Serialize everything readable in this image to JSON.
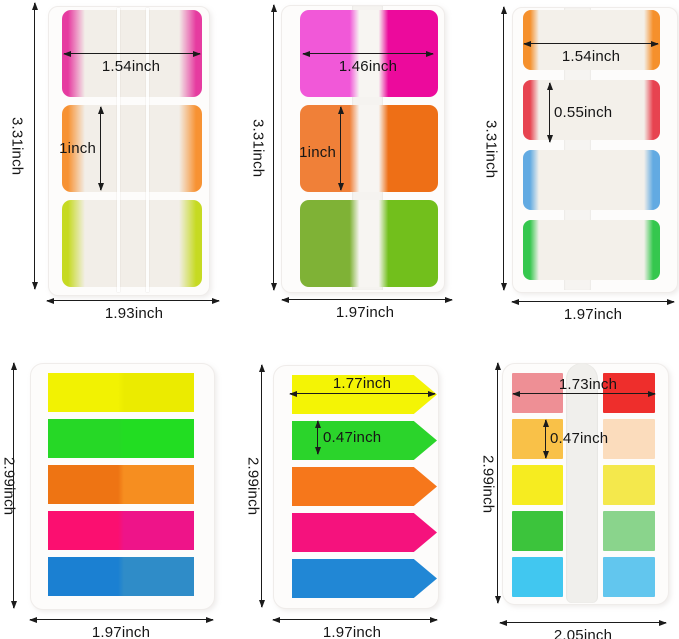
{
  "panels": [
    {
      "tab_style": "edge",
      "labels": {
        "overall_height": "3.31inch",
        "overall_width": "1.93inch",
        "tab_width": "1.54inch",
        "tab_height": "1inch"
      },
      "tab_colors": [
        "#e63ba0",
        "#f79233",
        "#c6da22"
      ]
    },
    {
      "tab_style": "half",
      "labels": {
        "overall_height": "3.31inch",
        "overall_width": "1.97inch",
        "tab_width": "1.46inch",
        "tab_height": "1inch"
      },
      "tab_colors": [
        [
          "#f158d8",
          "#ec0a9c"
        ],
        [
          "#f08038",
          "#ee6f16"
        ],
        [
          "#7fb236",
          "#72bf1c"
        ]
      ]
    },
    {
      "tab_style": "thin",
      "labels": {
        "overall_height": "3.31inch",
        "overall_width": "1.97inch",
        "tab_width": "1.54inch",
        "tab_height": "0.55inch"
      },
      "tab_colors": [
        "#f5902c",
        "#e74350",
        "#62aae2",
        "#35c74e"
      ]
    },
    {
      "tab_style": "strip",
      "labels": {
        "overall_height": "2.99inch",
        "overall_width": "1.97inch"
      },
      "tab_colors": [
        [
          "#f2f202",
          "#ebeb00"
        ],
        [
          "#26d826",
          "#22dd22"
        ],
        [
          "#ee7413",
          "#f68e20"
        ],
        [
          "#fb0f70",
          "#ee1489"
        ],
        [
          "#1b80d2",
          "#2f8cc8"
        ]
      ]
    },
    {
      "tab_style": "arrow",
      "labels": {
        "overall_height": "2.99inch",
        "overall_width": "1.97inch",
        "tab_width": "1.77inch",
        "tab_height": "0.47inch"
      },
      "tab_colors": [
        "#f4f405",
        "#2bd42b",
        "#f6771b",
        "#f5127d",
        "#2187d5"
      ]
    },
    {
      "tab_style": "pair",
      "labels": {
        "overall_height": "2.99inch",
        "overall_width": "2.05inch",
        "tab_width": "1.73inch",
        "tab_height": "0.47inch"
      },
      "tab_colors": [
        [
          "#ee8f95",
          "#ee2e2c"
        ],
        [
          "#f9c148",
          "#fbdcbc"
        ],
        [
          "#f6ec20",
          "#f4e84c"
        ],
        [
          "#3cc43c",
          "#8ad48c"
        ],
        [
          "#41c7f0",
          "#62c6ee"
        ]
      ]
    }
  ]
}
